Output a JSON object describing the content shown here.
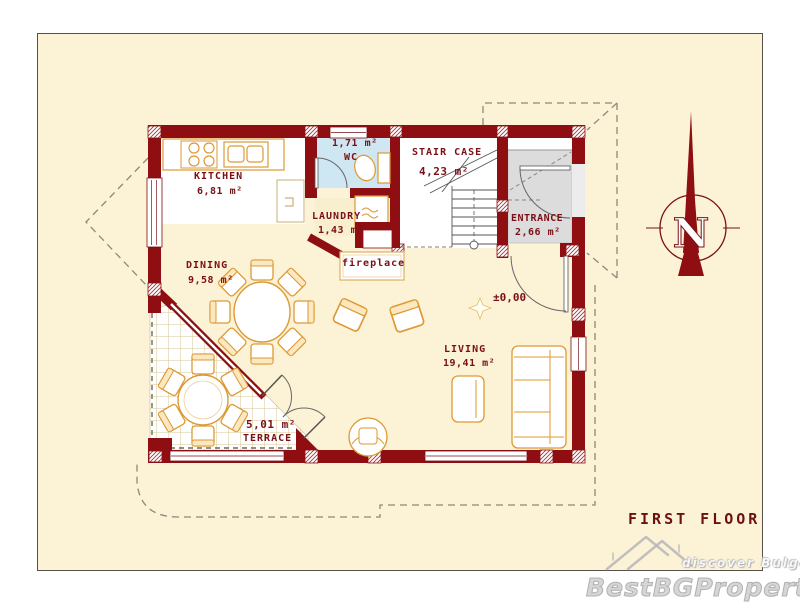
{
  "plan": {
    "title": "FIRST FLOOR",
    "level_marker": "±0,00",
    "compass": {
      "letter": "N"
    },
    "rooms": [
      {
        "id": "kitchen",
        "name": "KITCHEN",
        "area": "6,81 m²"
      },
      {
        "id": "wc",
        "name": "WC",
        "area": "1,71 m²"
      },
      {
        "id": "laundry",
        "name": "LAUNDRY",
        "area": "1,43 m²"
      },
      {
        "id": "staircase",
        "name": "STAIR CASE",
        "area": "4,23 m²"
      },
      {
        "id": "entrance",
        "name": "ENTRANCE",
        "area": "2,66 m²"
      },
      {
        "id": "dining",
        "name": "DINING",
        "area": "9,58 m²"
      },
      {
        "id": "living",
        "name": "LIVING",
        "area": "19,41 m²"
      },
      {
        "id": "terrace",
        "name": "TERRACE",
        "area": "5,01 m²"
      }
    ],
    "features": [
      {
        "label": "fireplace"
      }
    ]
  },
  "watermark": {
    "brand": "BestBGProperties",
    "tagline": "discover Bulgaria"
  },
  "colors": {
    "plan_background": "#fcf2d6",
    "wall": "#8e0e12",
    "label_text": "#7a1016",
    "furniture_outline": "#dd9933",
    "wc_floor": "#cfe7f2",
    "entrance_floor": "#dcdcdc"
  }
}
